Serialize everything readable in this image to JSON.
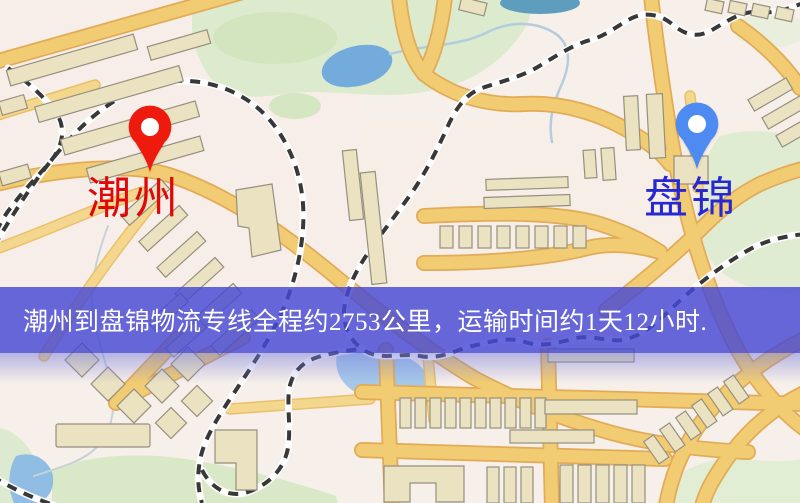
{
  "banner": {
    "text": "潮州到盘锦物流专线全程约2753公里，运输时间约1天12小时.",
    "background_color": "#4648d4",
    "text_color": "#ffffff"
  },
  "route_info": {
    "origin_city": "潮州",
    "destination_city": "盘锦",
    "distance_text": "约2753公里",
    "duration_text": "约1天12小时"
  },
  "markers": {
    "origin": {
      "label": "潮州",
      "pin_color": "#ee1a0d",
      "label_color": "#e00808",
      "pin_icon": "map-pin"
    },
    "destination": {
      "label": "盘锦",
      "pin_color": "#4d8af2",
      "label_color": "#2828d2",
      "pin_icon": "map-pin"
    }
  },
  "map_palette": {
    "background": "#f7efe9",
    "road_fill": "#f2cc72",
    "road_casing": "#e2ab58",
    "park_green": "#dcebcd",
    "water_blue": "#72abdc",
    "railway_dark": "#383838",
    "building_tan": "#ebe2c1"
  }
}
